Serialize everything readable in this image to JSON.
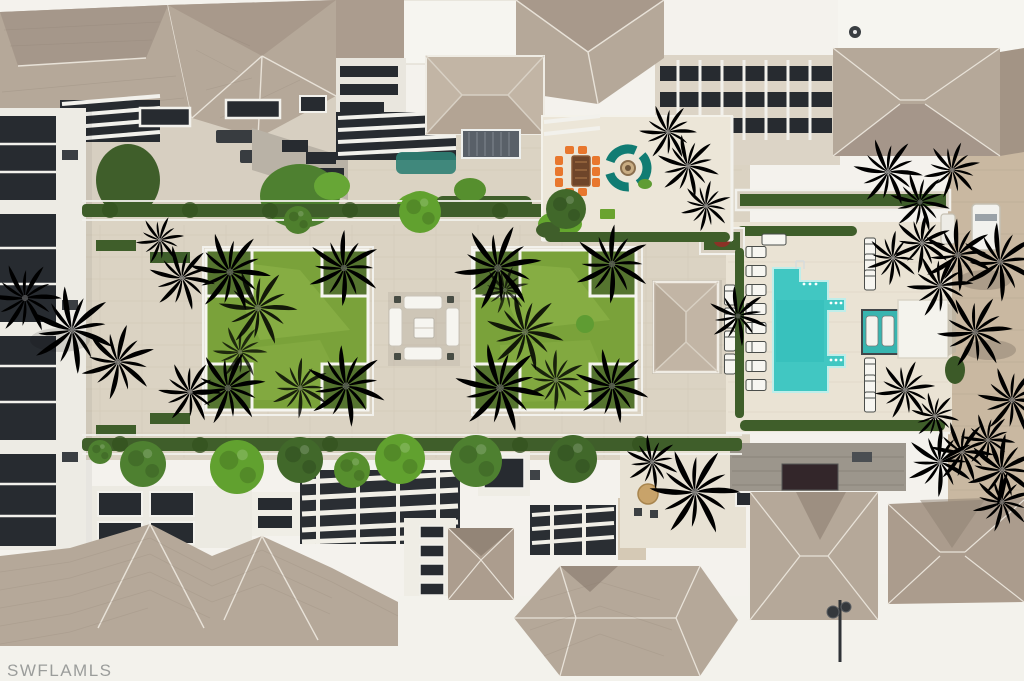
{
  "watermark": {
    "text": "SWFLAMLS",
    "color": "#9b9d9b"
  },
  "colors": {
    "sky_white": "#f4f2ed",
    "roof_tile": "#b5a899",
    "roof_tile_dark": "#a39485",
    "roof_tile_light": "#c2b5a5",
    "paver_walkway": "#dbd3c3",
    "pool_deck": "#eae3d4",
    "patio": "#ece6d8",
    "terrace": "#d7cfc1",
    "driveway_paver": "#c9b8a1",
    "glass_dark": "#272b30",
    "trim_white": "#f2f1ec",
    "lawn": "#7aa23a",
    "lawn_light": "#94ba50",
    "hedge": "#3f5e2a",
    "tree_bright": "#61a12f",
    "tree_dark": "#41682a",
    "palm_bright": "#7cbb40",
    "palm_pale": "#a8b684",
    "palm_shadow": "#2f4a1f",
    "pool_water": "#41c7c2",
    "spa_water": "#38b5b0",
    "sofa_teal": "#117c73",
    "furniture_orange": "#e8772e",
    "umbrella_tan": "#c8a36a"
  }
}
